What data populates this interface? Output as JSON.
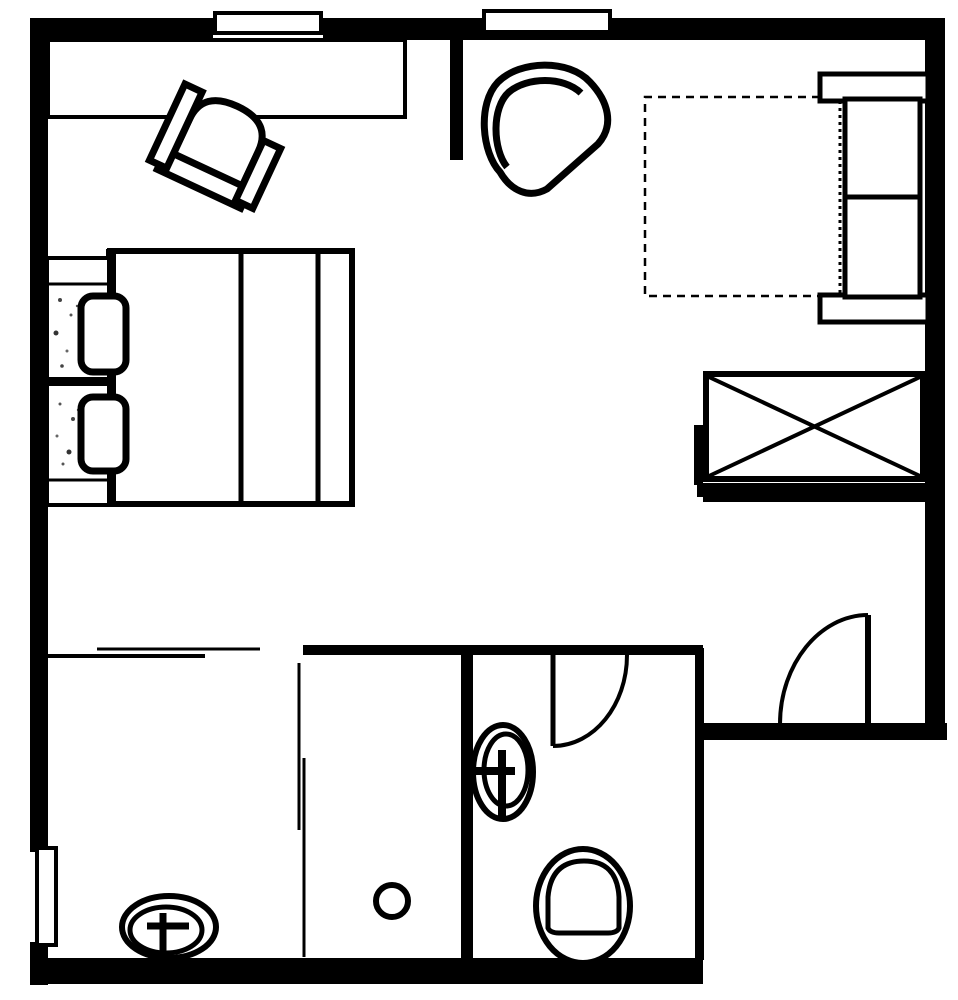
{
  "meta": {
    "label": "hotel-room-floor-plan",
    "ink_color": "#000000",
    "background_color": "#ffffff",
    "canvas": {
      "width": 958,
      "height": 1000
    }
  },
  "elements": [
    {
      "name": "wall-top",
      "type": "rect",
      "attrs": {
        "x": 30,
        "y": 18,
        "width": 915,
        "height": 22,
        "fill": "#000000"
      }
    },
    {
      "name": "wall-left",
      "type": "rect",
      "attrs": {
        "x": 30,
        "y": 18,
        "width": 18,
        "height": 967,
        "fill": "#000000"
      }
    },
    {
      "name": "wall-right",
      "type": "rect",
      "attrs": {
        "x": 925,
        "y": 18,
        "width": 20,
        "height": 722,
        "fill": "#000000"
      }
    },
    {
      "name": "wall-bottom",
      "type": "rect",
      "attrs": {
        "x": 30,
        "y": 958,
        "width": 673,
        "height": 26,
        "fill": "#000000"
      }
    },
    {
      "name": "entry-wall",
      "type": "rect",
      "attrs": {
        "x": 695,
        "y": 723,
        "width": 252,
        "height": 17,
        "fill": "#000000"
      }
    },
    {
      "name": "closet-wall-bottom",
      "type": "rect",
      "attrs": {
        "x": 697,
        "y": 483,
        "width": 230,
        "height": 14,
        "fill": "#000000"
      }
    },
    {
      "name": "closet-wall-ledge",
      "type": "rect",
      "attrs": {
        "x": 703,
        "y": 497,
        "width": 224,
        "height": 5,
        "fill": "#000000"
      }
    },
    {
      "name": "closet-wall-stub",
      "type": "rect",
      "attrs": {
        "x": 694,
        "y": 425,
        "width": 9,
        "height": 60,
        "fill": "#000000"
      }
    },
    {
      "name": "bathroom-top-wall",
      "type": "rect",
      "attrs": {
        "x": 303,
        "y": 645,
        "width": 400,
        "height": 10,
        "fill": "#000000"
      }
    },
    {
      "name": "divider-wall",
      "type": "rect",
      "attrs": {
        "x": 461,
        "y": 645,
        "width": 12,
        "height": 315,
        "fill": "#000000"
      }
    },
    {
      "name": "bathroom-right-wall",
      "type": "rect",
      "attrs": {
        "x": 695,
        "y": 648,
        "width": 9,
        "height": 312,
        "fill": "#000000"
      }
    },
    {
      "name": "interior-wall-stub",
      "type": "rect",
      "attrs": {
        "x": 450,
        "y": 38,
        "width": 13,
        "height": 122,
        "fill": "#000000"
      }
    },
    {
      "name": "window-top-left-gap",
      "type": "rect",
      "attrs": {
        "x": 213,
        "y": 17,
        "width": 110,
        "height": 24,
        "fill": "#ffffff"
      }
    },
    {
      "name": "window-top-left-frame",
      "type": "rect",
      "attrs": {
        "x": 215,
        "y": 13,
        "width": 106,
        "height": 20,
        "fill": "#ffffff",
        "stroke": "#000000",
        "stroke-width": 4
      }
    },
    {
      "name": "window-top-middle-gap",
      "type": "rect",
      "attrs": {
        "x": 482,
        "y": 17,
        "width": 130,
        "height": 16,
        "fill": "#ffffff"
      }
    },
    {
      "name": "window-top-middle-frame",
      "type": "rect",
      "attrs": {
        "x": 484,
        "y": 11,
        "width": 126,
        "height": 21,
        "fill": "#ffffff",
        "stroke": "#000000",
        "stroke-width": 4
      }
    },
    {
      "name": "window-left-gap",
      "type": "rect",
      "attrs": {
        "x": 30,
        "y": 852,
        "width": 18,
        "height": 90,
        "fill": "#ffffff"
      }
    },
    {
      "name": "window-left-frame",
      "type": "rect",
      "attrs": {
        "x": 37,
        "y": 848,
        "width": 19,
        "height": 97,
        "fill": "#ffffff",
        "stroke": "#000000",
        "stroke-width": 4
      }
    },
    {
      "name": "desk",
      "type": "rect",
      "attrs": {
        "x": 48,
        "y": 40,
        "width": 357,
        "height": 77,
        "fill": "#ffffff",
        "stroke": "#000000",
        "stroke-width": 4
      }
    },
    {
      "name": "desk-chair-seat",
      "type": "path",
      "attrs": {
        "d": "M -38 42 L -38 -14 Q -38 -46 0 -46 Q 38 -46 38 -14 L 38 42 Z",
        "fill": "#ffffff",
        "stroke": "#000000",
        "stroke-width": 7,
        "transform": "translate(218,148) rotate(25)"
      }
    },
    {
      "name": "desk-chair-front",
      "type": "rect",
      "attrs": {
        "x": -46,
        "y": 24,
        "width": 92,
        "height": 21,
        "fill": "#ffffff",
        "stroke": "#000000",
        "stroke-width": 7,
        "transform": "translate(218,148) rotate(25)"
      }
    },
    {
      "name": "desk-chair-arm-left",
      "type": "rect",
      "attrs": {
        "x": -57,
        "y": -44,
        "width": 19,
        "height": 84,
        "fill": "#ffffff",
        "stroke": "#000000",
        "stroke-width": 7,
        "transform": "translate(218,148) rotate(25)"
      }
    },
    {
      "name": "desk-chair-arm-right",
      "type": "rect",
      "attrs": {
        "x": 38,
        "y": -26,
        "width": 19,
        "height": 66,
        "fill": "#ffffff",
        "stroke": "#000000",
        "stroke-width": 7,
        "transform": "translate(218,148) rotate(25)"
      }
    },
    {
      "name": "armchair-body",
      "type": "path",
      "attrs": {
        "d": "M 500 172 C 482 153 477 104 498 82 C 520 60 569 59 590 82 C 608 101 615 125 598 144 L 547 189 C 529 199 511 191 500 172 Z",
        "fill": "#ffffff",
        "stroke": "#000000",
        "stroke-width": 7
      }
    },
    {
      "name": "armchair-back-line",
      "type": "path",
      "attrs": {
        "d": "M 507 167 C 493 150 491 108 509 92 C 527 77 563 76 581 93",
        "fill": "none",
        "stroke": "#000000",
        "stroke-width": 7
      }
    },
    {
      "name": "bed-body",
      "type": "rect",
      "attrs": {
        "x": 110,
        "y": 251,
        "width": 242,
        "height": 253,
        "fill": "#ffffff",
        "stroke": "#000000",
        "stroke-width": 6
      }
    },
    {
      "name": "bed-fold-line-left",
      "type": "line",
      "attrs": {
        "x1": 241,
        "y1": 253,
        "x2": 241,
        "y2": 502,
        "stroke": "#000000",
        "stroke-width": 5
      }
    },
    {
      "name": "bed-fold-line-right",
      "type": "line",
      "attrs": {
        "x1": 318,
        "y1": 253,
        "x2": 318,
        "y2": 502,
        "stroke": "#000000",
        "stroke-width": 5
      }
    },
    {
      "name": "bed-headboard",
      "type": "rect",
      "attrs": {
        "x": 106,
        "y": 249,
        "width": 10,
        "height": 257,
        "fill": "#000000"
      }
    },
    {
      "name": "nightstand-top",
      "type": "rect",
      "attrs": {
        "x": 47,
        "y": 258,
        "width": 62,
        "height": 121,
        "fill": "#ffffff",
        "stroke": "#000000",
        "stroke-width": 4
      }
    },
    {
      "name": "nightstand-top-line",
      "type": "line",
      "attrs": {
        "x1": 47,
        "y1": 284,
        "x2": 109,
        "y2": 284,
        "stroke": "#000000",
        "stroke-width": 3
      }
    },
    {
      "name": "nightstand-bottom",
      "type": "rect",
      "attrs": {
        "x": 47,
        "y": 384,
        "width": 62,
        "height": 121,
        "fill": "#ffffff",
        "stroke": "#000000",
        "stroke-width": 4
      }
    },
    {
      "name": "nightstand-bottom-line",
      "type": "line",
      "attrs": {
        "x1": 47,
        "y1": 480,
        "x2": 109,
        "y2": 480,
        "stroke": "#000000",
        "stroke-width": 3
      }
    },
    {
      "name": "bed-split-line",
      "type": "line",
      "attrs": {
        "x1": 44,
        "y1": 381,
        "x2": 107,
        "y2": 381,
        "stroke": "#000000",
        "stroke-width": 3
      }
    },
    {
      "name": "stipple-dot",
      "type": "circle",
      "attrs": {
        "cx": 60,
        "cy": 300,
        "r": 2,
        "fill": "#444444"
      }
    },
    {
      "name": "stipple-dot",
      "type": "circle",
      "attrs": {
        "cx": 71,
        "cy": 315,
        "r": 1.5,
        "fill": "#555555"
      }
    },
    {
      "name": "stipple-dot",
      "type": "circle",
      "attrs": {
        "cx": 56,
        "cy": 333,
        "r": 2.5,
        "fill": "#333333"
      }
    },
    {
      "name": "stipple-dot",
      "type": "circle",
      "attrs": {
        "cx": 67,
        "cy": 351,
        "r": 1.5,
        "fill": "#666666"
      }
    },
    {
      "name": "stipple-dot",
      "type": "circle",
      "attrs": {
        "cx": 77,
        "cy": 306,
        "r": 1.2,
        "fill": "#555555"
      }
    },
    {
      "name": "stipple-dot",
      "type": "circle",
      "attrs": {
        "cx": 62,
        "cy": 366,
        "r": 1.8,
        "fill": "#444444"
      }
    },
    {
      "name": "stipple-dot",
      "type": "circle",
      "attrs": {
        "cx": 60,
        "cy": 404,
        "r": 1.5,
        "fill": "#555555"
      }
    },
    {
      "name": "stipple-dot",
      "type": "circle",
      "attrs": {
        "cx": 73,
        "cy": 419,
        "r": 2,
        "fill": "#444444"
      }
    },
    {
      "name": "stipple-dot",
      "type": "circle",
      "attrs": {
        "cx": 57,
        "cy": 436,
        "r": 1.5,
        "fill": "#666666"
      }
    },
    {
      "name": "stipple-dot",
      "type": "circle",
      "attrs": {
        "cx": 69,
        "cy": 452,
        "r": 2.5,
        "fill": "#333333"
      }
    },
    {
      "name": "stipple-dot",
      "type": "circle",
      "attrs": {
        "cx": 63,
        "cy": 464,
        "r": 1.5,
        "fill": "#555555"
      }
    },
    {
      "name": "stipple-dot",
      "type": "circle",
      "attrs": {
        "cx": 78,
        "cy": 410,
        "r": 1.2,
        "fill": "#555555"
      }
    },
    {
      "name": "pillow-top",
      "type": "rect",
      "attrs": {
        "x": 81,
        "y": 296,
        "width": 45,
        "height": 76,
        "rx": 12,
        "fill": "#ffffff",
        "stroke": "#000000",
        "stroke-width": 7
      }
    },
    {
      "name": "pillow-bottom",
      "type": "rect",
      "attrs": {
        "x": 81,
        "y": 397,
        "width": 45,
        "height": 74,
        "rx": 12,
        "fill": "#ffffff",
        "stroke": "#000000",
        "stroke-width": 7
      }
    },
    {
      "name": "rug-dashed-outline",
      "type": "path",
      "attrs": {
        "d": "M 820 97 L 645 97 L 645 296 L 820 296",
        "fill": "none",
        "stroke": "#000000",
        "stroke-width": 2.5,
        "stroke-dasharray": "8,6"
      }
    },
    {
      "name": "sofa-armrest-top",
      "type": "rect",
      "attrs": {
        "x": 820,
        "y": 74,
        "width": 108,
        "height": 27,
        "fill": "#ffffff",
        "stroke": "#000000",
        "stroke-width": 5
      }
    },
    {
      "name": "sofa-armrest-bottom",
      "type": "rect",
      "attrs": {
        "x": 820,
        "y": 295,
        "width": 108,
        "height": 27,
        "fill": "#ffffff",
        "stroke": "#000000",
        "stroke-width": 5
      }
    },
    {
      "name": "sofa-body",
      "type": "rect",
      "attrs": {
        "x": 845,
        "y": 99,
        "width": 75,
        "height": 198,
        "fill": "#ffffff",
        "stroke": "#000000",
        "stroke-width": 5
      }
    },
    {
      "name": "sofa-cushion-divider",
      "type": "line",
      "attrs": {
        "x1": 845,
        "y1": 197,
        "x2": 920,
        "y2": 197,
        "stroke": "#000000",
        "stroke-width": 5
      }
    },
    {
      "name": "sofa-front-dotted-line",
      "type": "line",
      "attrs": {
        "x1": 840,
        "y1": 101,
        "x2": 840,
        "y2": 295,
        "stroke": "#000000",
        "stroke-width": 3,
        "stroke-dasharray": "3,4"
      }
    },
    {
      "name": "wardrobe-box",
      "type": "rect",
      "attrs": {
        "x": 706,
        "y": 374,
        "width": 217,
        "height": 105,
        "fill": "#ffffff",
        "stroke": "#000000",
        "stroke-width": 6
      }
    },
    {
      "name": "wardrobe-diagonal-1",
      "type": "line",
      "attrs": {
        "x1": 709,
        "y1": 377,
        "x2": 920,
        "y2": 476,
        "stroke": "#000000",
        "stroke-width": 4
      }
    },
    {
      "name": "wardrobe-diagonal-2",
      "type": "line",
      "attrs": {
        "x1": 709,
        "y1": 476,
        "x2": 920,
        "y2": 377,
        "stroke": "#000000",
        "stroke-width": 4
      }
    },
    {
      "name": "bathroom-door-leaf",
      "type": "line",
      "attrs": {
        "x1": 553,
        "y1": 653,
        "x2": 553,
        "y2": 746,
        "stroke": "#000000",
        "stroke-width": 5
      }
    },
    {
      "name": "bathroom-door-arc",
      "type": "path",
      "attrs": {
        "d": "M 553 746 C 594 746 627 705 627 655",
        "fill": "none",
        "stroke": "#000000",
        "stroke-width": 4
      }
    },
    {
      "name": "entry-door-leaf",
      "type": "line",
      "attrs": {
        "x1": 868,
        "y1": 615,
        "x2": 868,
        "y2": 724,
        "stroke": "#000000",
        "stroke-width": 6
      }
    },
    {
      "name": "entry-door-arc",
      "type": "path",
      "attrs": {
        "d": "M 780 724 C 780 664 820 615 868 615",
        "fill": "none",
        "stroke": "#000000",
        "stroke-width": 4
      }
    },
    {
      "name": "shower-partition-line-1",
      "type": "line",
      "attrs": {
        "x1": 299,
        "y1": 663,
        "x2": 299,
        "y2": 830,
        "stroke": "#000000",
        "stroke-width": 3
      }
    },
    {
      "name": "shower-partition-line-2",
      "type": "line",
      "attrs": {
        "x1": 304,
        "y1": 758,
        "x2": 304,
        "y2": 957,
        "stroke": "#000000",
        "stroke-width": 3
      }
    },
    {
      "name": "closet-slide-line-1",
      "type": "line",
      "attrs": {
        "x1": 97,
        "y1": 649,
        "x2": 260,
        "y2": 649,
        "stroke": "#000000",
        "stroke-width": 3
      }
    },
    {
      "name": "closet-slide-line-2",
      "type": "line",
      "attrs": {
        "x1": 48,
        "y1": 656,
        "x2": 205,
        "y2": 656,
        "stroke": "#000000",
        "stroke-width": 4
      }
    },
    {
      "name": "shower-drain",
      "type": "circle",
      "attrs": {
        "cx": 392,
        "cy": 901,
        "r": 16,
        "fill": "#ffffff",
        "stroke": "#000000",
        "stroke-width": 6
      }
    },
    {
      "name": "bathroom-sink-outer",
      "type": "ellipse",
      "attrs": {
        "cx": 503,
        "cy": 772,
        "rx": 30,
        "ry": 47,
        "fill": "#ffffff",
        "stroke": "#000000",
        "stroke-width": 6
      }
    },
    {
      "name": "bathroom-sink-inner",
      "type": "ellipse",
      "attrs": {
        "cx": 506,
        "cy": 770,
        "rx": 22,
        "ry": 36,
        "fill": "none",
        "stroke": "#000000",
        "stroke-width": 5
      }
    },
    {
      "name": "bathroom-sink-tap-vertical",
      "type": "line",
      "attrs": {
        "x1": 502,
        "y1": 750,
        "x2": 502,
        "y2": 816,
        "stroke": "#000000",
        "stroke-width": 8
      }
    },
    {
      "name": "bathroom-sink-tap-horizontal",
      "type": "line",
      "attrs": {
        "x1": 474,
        "y1": 771,
        "x2": 515,
        "y2": 771,
        "stroke": "#000000",
        "stroke-width": 8
      }
    },
    {
      "name": "toilet-outer",
      "type": "ellipse",
      "attrs": {
        "cx": 583,
        "cy": 906,
        "rx": 47,
        "ry": 57,
        "fill": "#ffffff",
        "stroke": "#000000",
        "stroke-width": 6
      }
    },
    {
      "name": "toilet-bowl",
      "type": "path",
      "attrs": {
        "d": "M 548 928 L 548 897 Q 551 861 584 861 Q 617 861 619 897 L 619 928 Q 617 933 608 933 L 559 933 Q 550 933 548 928 Z",
        "fill": "none",
        "stroke": "#000000",
        "stroke-width": 5
      }
    },
    {
      "name": "vanity-sink-outer",
      "type": "ellipse",
      "attrs": {
        "cx": 169,
        "cy": 927,
        "rx": 47,
        "ry": 31,
        "fill": "#ffffff",
        "stroke": "#000000",
        "stroke-width": 6
      }
    },
    {
      "name": "vanity-sink-inner",
      "type": "ellipse",
      "attrs": {
        "cx": 166,
        "cy": 930,
        "rx": 36,
        "ry": 23,
        "fill": "none",
        "stroke": "#000000",
        "stroke-width": 5
      }
    },
    {
      "name": "vanity-sink-tap-horizontal",
      "type": "line",
      "attrs": {
        "x1": 147,
        "y1": 926,
        "x2": 189,
        "y2": 926,
        "stroke": "#000000",
        "stroke-width": 7
      }
    },
    {
      "name": "vanity-sink-tap-vertical",
      "type": "line",
      "attrs": {
        "x1": 163,
        "y1": 913,
        "x2": 163,
        "y2": 958,
        "stroke": "#000000",
        "stroke-width": 7
      }
    }
  ]
}
